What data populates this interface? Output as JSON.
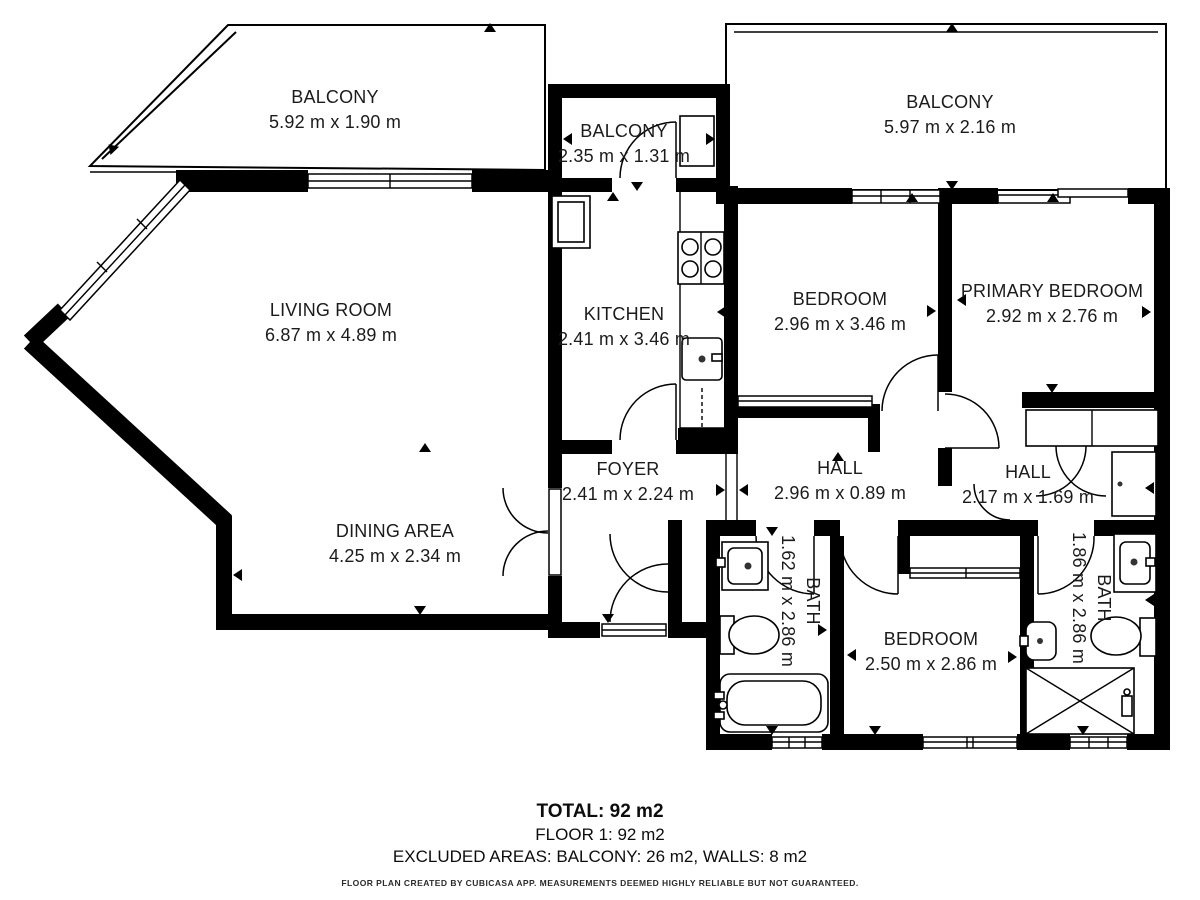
{
  "plan": {
    "rooms": {
      "balcony_tl": {
        "name": "BALCONY",
        "dims": "5.92 m x 1.90 m"
      },
      "balcony_mid": {
        "name": "BALCONY",
        "dims": "2.35 m x 1.31 m"
      },
      "balcony_tr": {
        "name": "BALCONY",
        "dims": "5.97 m x 2.16 m"
      },
      "living_room": {
        "name": "LIVING ROOM",
        "dims": "6.87 m x 4.89 m"
      },
      "kitchen": {
        "name": "KITCHEN",
        "dims": "2.41 m x 3.46 m"
      },
      "bedroom_top": {
        "name": "BEDROOM",
        "dims": "2.96 m x 3.46 m"
      },
      "primary_bedroom": {
        "name": "PRIMARY BEDROOM",
        "dims": "2.92 m x 2.76 m"
      },
      "foyer": {
        "name": "FOYER",
        "dims": "2.41 m x 2.24 m"
      },
      "hall_center": {
        "name": "HALL",
        "dims": "2.96 m x 0.89 m"
      },
      "hall_right": {
        "name": "HALL",
        "dims": "2.17 m x 1.69 m"
      },
      "dining_area": {
        "name": "DINING AREA",
        "dims": "4.25 m x 2.34 m"
      },
      "bath_left": {
        "name": "BATH",
        "dims": "1.62 m x 2.86 m"
      },
      "bedroom_bottom": {
        "name": "BEDROOM",
        "dims": "2.50 m x 2.86 m"
      },
      "bath_right": {
        "name": "BATH",
        "dims": "1.86 m x 2.86 m"
      }
    },
    "summary": {
      "total": "TOTAL: 92 m2",
      "floor": "FLOOR 1: 92 m2",
      "excluded": "EXCLUDED AREAS: BALCONY: 26 m2, WALLS: 8 m2",
      "disclaimer": "FLOOR PLAN CREATED BY CUBICASA APP. MEASUREMENTS DEEMED HIGHLY RELIABLE BUT NOT GUARANTEED."
    },
    "colors": {
      "wall": "#000000",
      "background": "#ffffff",
      "text": "#1b1b1b"
    }
  }
}
